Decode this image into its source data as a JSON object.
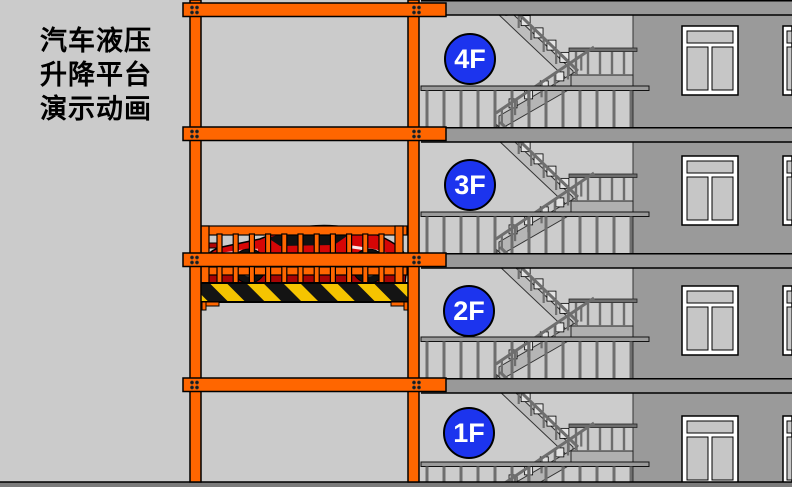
{
  "title": {
    "line1": "汽车液压",
    "line2": "升降平台",
    "line3": "演示动画"
  },
  "floors": [
    {
      "label": "4F"
    },
    {
      "label": "3F"
    },
    {
      "label": "2F"
    },
    {
      "label": "1F"
    }
  ],
  "colors": {
    "frame_orange": "#ff6600",
    "floor_badge_blue": "#1c34ee",
    "hazard_yellow": "#f5c400",
    "hazard_black": "#141414",
    "car_red": "#d60606",
    "wall_gray": "#9a9a9a",
    "slab_gray": "#999999",
    "stairwell_gray": "#cccccc",
    "background_gray": "#cbcbcb",
    "railing_gray": "#6e6e6e"
  }
}
